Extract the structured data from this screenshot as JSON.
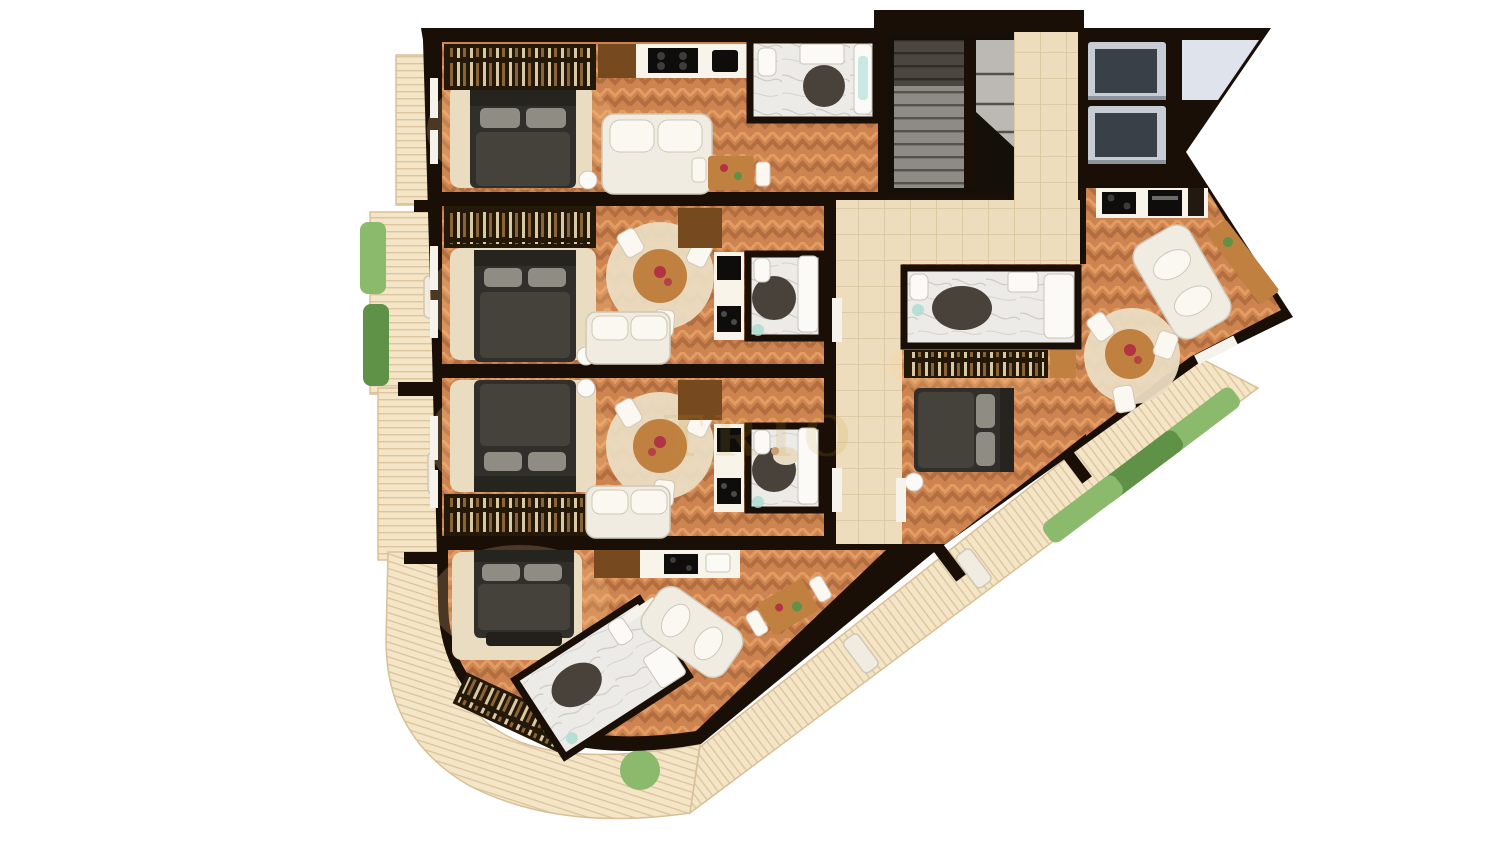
{
  "scene": {
    "name": "apartment-floor-plan-3d-render",
    "description": "Top-down 3D render of a residential floor with four studio apartments, stair and elevator core, corridor, two corner units, plank balconies with hedge planters and a curved corner terrace"
  },
  "watermark": {
    "small_text": "CASA",
    "large_text": "TRIO"
  },
  "palette": {
    "background": "#ffffff",
    "wall": "#190f07",
    "floor_base": "#cd8450",
    "floor_dark": "#a9663a",
    "floor_light": "#e8a368",
    "corridor_tile": "#eeddbd",
    "corridor_line": "#d9c49c",
    "marble": "#edebe7",
    "marble_vein": "#c6c1ba",
    "deck": "#f4e5c7",
    "deck_line": "#d9c097",
    "rug": "#eadcc1",
    "bed_frame": "#312f2b",
    "bed_blanket": "#45423c",
    "bed_pillow": "#8f8c84",
    "sofa": "#f1ece1",
    "sofa_shadow": "#cfc8b8",
    "wood": "#c08040",
    "wood_dark": "#77491f",
    "wardrobe": "#241809",
    "counter": "#f8f4ea",
    "appliance": "#0e0d0c",
    "stair_mid": "#8e8a85",
    "stair_step": "#55514b",
    "stair_light": "#bcb9b5",
    "stair_dark": "#150f09",
    "elevator_shell": "#c8cdd5",
    "elevator_cab": "#3a4047",
    "plant": "#8cba6d",
    "plant_dark": "#5f9146",
    "bath_rug": "#48423a",
    "bath_mat": "#a8dcd2",
    "flower": "#b23343",
    "glow": "#ffce8f",
    "watermark": "#c59a2a",
    "notch_light": "#dfe4ec",
    "door_white": "#f6f3ed"
  }
}
